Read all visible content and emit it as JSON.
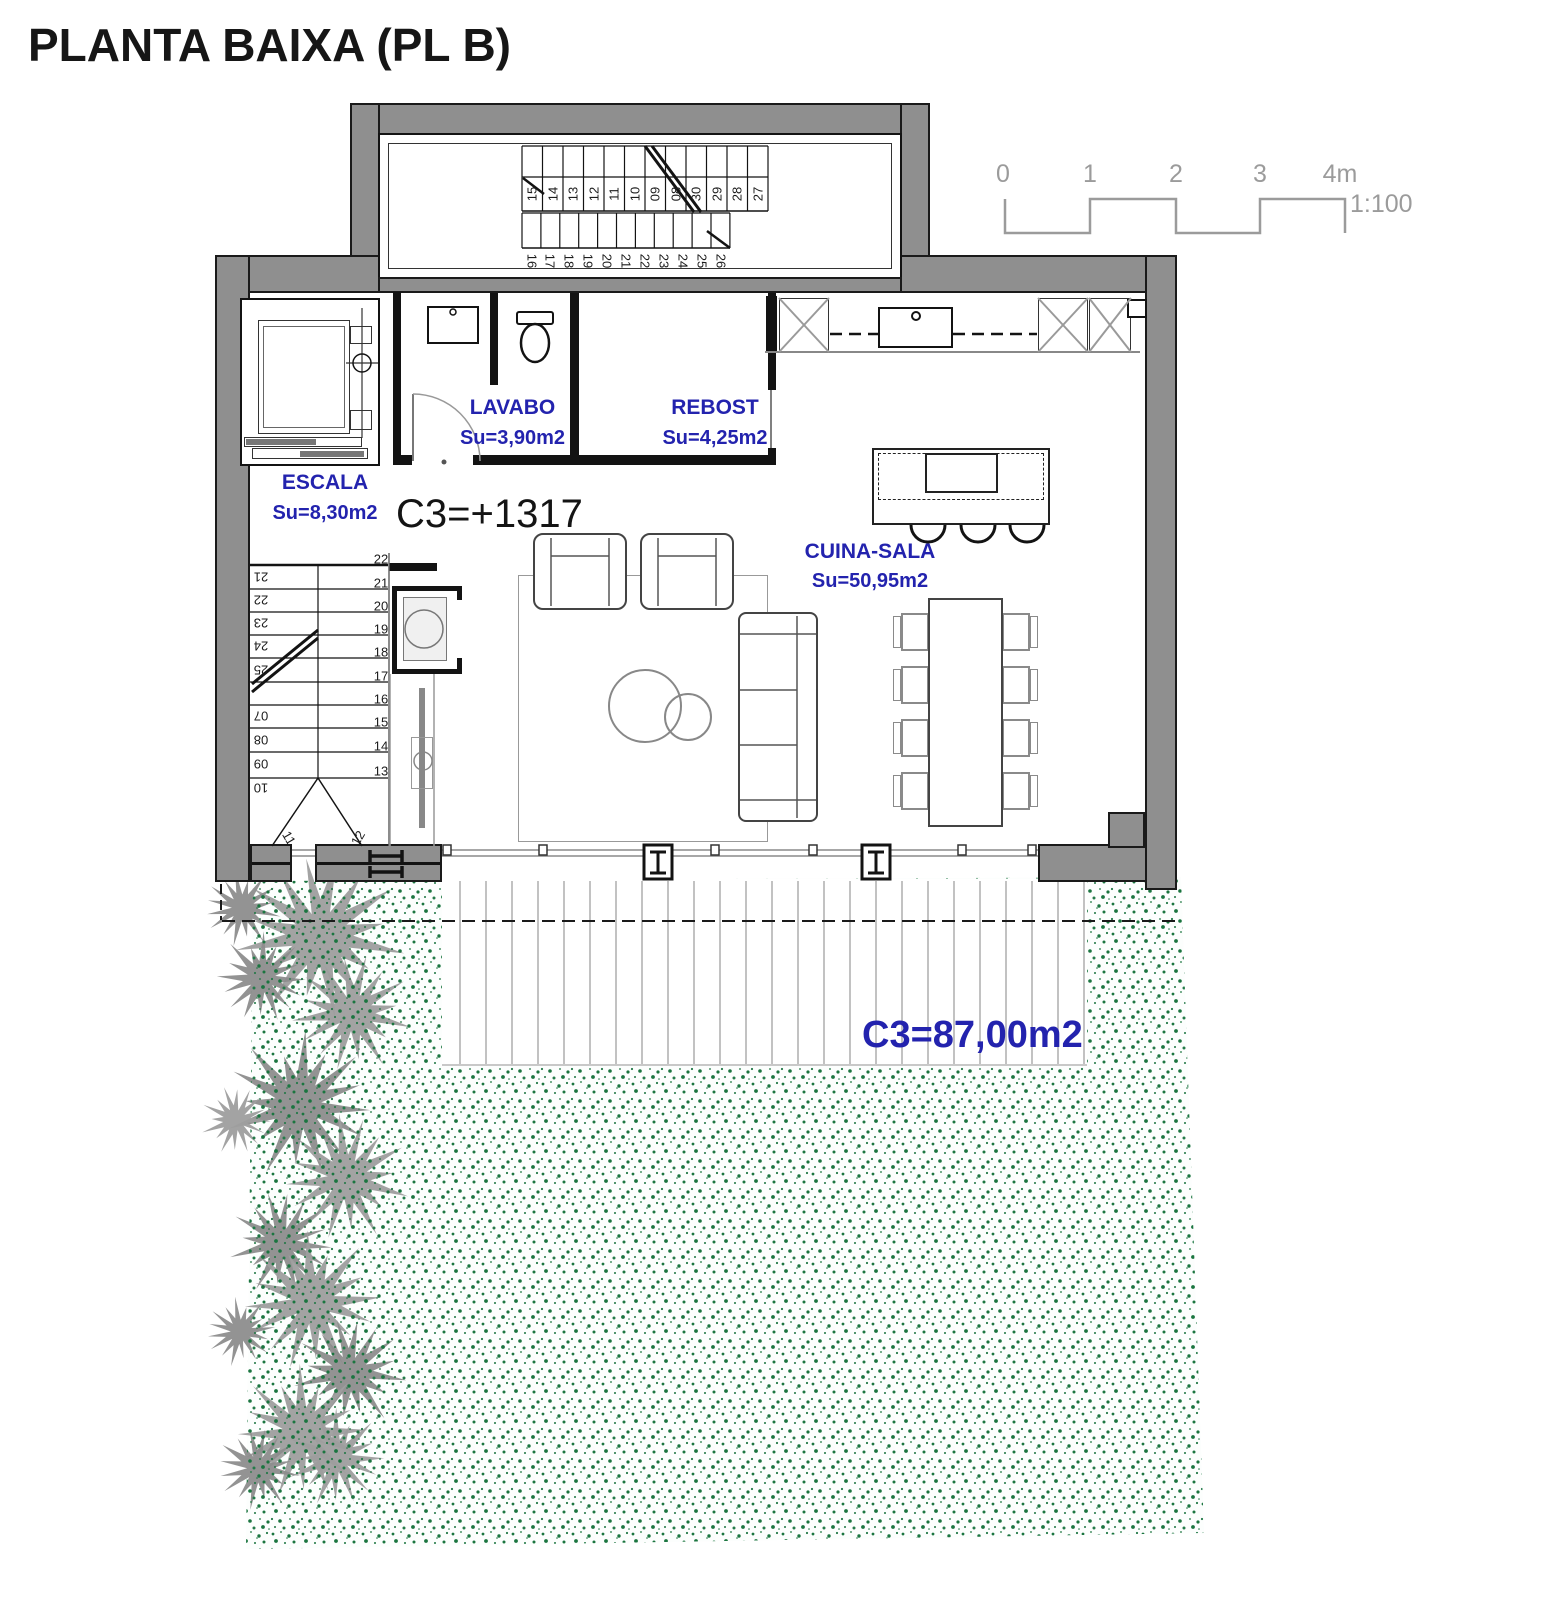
{
  "title": "PLANTA BAIXA (PL B)",
  "scale": {
    "ticks": [
      "0",
      "1",
      "2",
      "3",
      "4m"
    ],
    "ratio": "1:100"
  },
  "rooms": [
    {
      "name": "LAVABO",
      "area": "Su=3,90m2"
    },
    {
      "name": "REBOST",
      "area": "Su=4,25m2"
    },
    {
      "name": "ESCALA",
      "area": "Su=8,30m2"
    },
    {
      "name": "CUINA-SALA",
      "area": "Su=50,95m2"
    }
  ],
  "annotations": {
    "level_mark": "C3=+1317",
    "terrace_area": "C3=87,00m2"
  },
  "stairs": {
    "upper_run_top": [
      "15",
      "14",
      "13",
      "12",
      "11",
      "10",
      "09",
      "08",
      "30",
      "29",
      "28",
      "27"
    ],
    "lower_run_top": [
      "16",
      "17",
      "18",
      "19",
      "20",
      "21",
      "22",
      "23",
      "24",
      "25",
      "26"
    ],
    "left_flight_outer": [
      "21",
      "22",
      "23",
      "24",
      "25",
      "07",
      "08",
      "09",
      "10"
    ],
    "left_flight_inner": [
      "22",
      "21",
      "20",
      "19",
      "18",
      "17",
      "16",
      "15",
      "14",
      "13"
    ],
    "winders": [
      "11",
      "12"
    ]
  },
  "colors": {
    "wall_gray": "#8f8f8f",
    "accent_blue": "#2323ae",
    "garden_green": "#1b7540",
    "plant_gray": "#9a9a9a",
    "line_gray": "#9a9a9a",
    "outline_black": "#131313"
  }
}
